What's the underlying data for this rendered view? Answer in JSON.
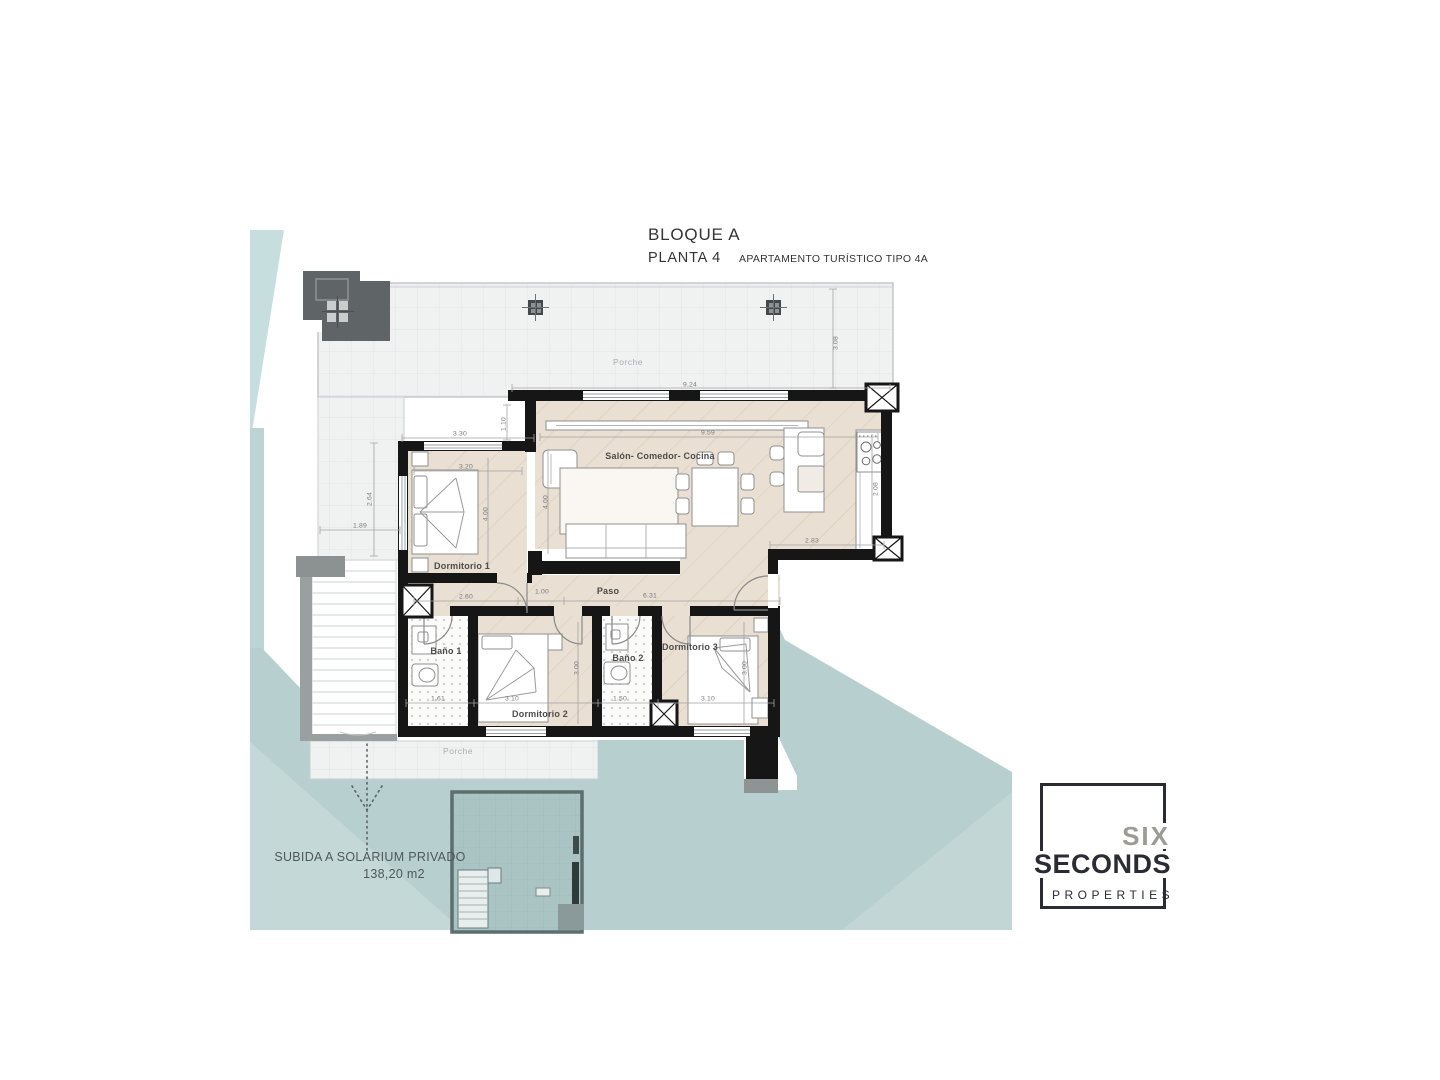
{
  "title_block": {
    "project": "BLOQUE A",
    "floor": "PLANTA 4",
    "unit_type": "APARTAMENTO TURÍSTICO TIPO 4A"
  },
  "rooms": {
    "living": "Salón- Comedor- Cocina",
    "bedroom1": "Dormitorio 1",
    "bedroom2": "Dormitorio 2",
    "bedroom3": "Dormitorio 3",
    "bath1": "Baño 1",
    "bath2": "Baño 2",
    "hall": "Paso",
    "porch_top": "Porche",
    "porch_bottom": "Porche"
  },
  "annotation": {
    "line1": "SUBIDA A SOLARIUM PRIVADO",
    "line2": "138,20 m2"
  },
  "logo": {
    "line1": "SIX",
    "line2": "SECONDS",
    "line3": "PROPERTIES"
  },
  "colors": {
    "teal": "#b7cfcf",
    "teal_light": "#c7dede",
    "floor_wood": "#e9dfd2",
    "wall_black": "#161616",
    "porch_gray": "#f0f2f2",
    "core_gray": "#5f6466",
    "logo_dark": "#2b2b33",
    "logo_gray": "#9c9c94"
  },
  "dimensions": [
    {
      "label": "9.24",
      "x": 690,
      "y": 385,
      "rot": 0
    },
    {
      "label": "9.59",
      "x": 708,
      "y": 433,
      "rot": 0
    },
    {
      "label": "1.10",
      "x": 504,
      "y": 424,
      "rot": -90
    },
    {
      "label": "3.30",
      "x": 460,
      "y": 434,
      "rot": 0
    },
    {
      "label": "3.20",
      "x": 466,
      "y": 467,
      "rot": 0
    },
    {
      "label": "2.64",
      "x": 370,
      "y": 499,
      "rot": -90
    },
    {
      "label": "1.89",
      "x": 360,
      "y": 526,
      "rot": 0
    },
    {
      "label": "4.00",
      "x": 486,
      "y": 514,
      "rot": -90
    },
    {
      "label": "4.00",
      "x": 546,
      "y": 502,
      "rot": -90
    },
    {
      "label": "3.08",
      "x": 836,
      "y": 343,
      "rot": -90
    },
    {
      "label": "2.08",
      "x": 876,
      "y": 489,
      "rot": -90
    },
    {
      "label": "2.83",
      "x": 812,
      "y": 541,
      "rot": 0
    },
    {
      "label": "2.60",
      "x": 466,
      "y": 597,
      "rot": 0
    },
    {
      "label": "1.00",
      "x": 542,
      "y": 592,
      "rot": 0
    },
    {
      "label": "6.31",
      "x": 650,
      "y": 596,
      "rot": 0
    },
    {
      "label": "1.61",
      "x": 438,
      "y": 699,
      "rot": 0
    },
    {
      "label": "3.10",
      "x": 512,
      "y": 699,
      "rot": 0
    },
    {
      "label": "1.50",
      "x": 620,
      "y": 699,
      "rot": 0
    },
    {
      "label": "3.10",
      "x": 708,
      "y": 699,
      "rot": 0
    },
    {
      "label": "3.00",
      "x": 577,
      "y": 668,
      "rot": -90
    },
    {
      "label": "3.00",
      "x": 745,
      "y": 668,
      "rot": -90
    }
  ]
}
